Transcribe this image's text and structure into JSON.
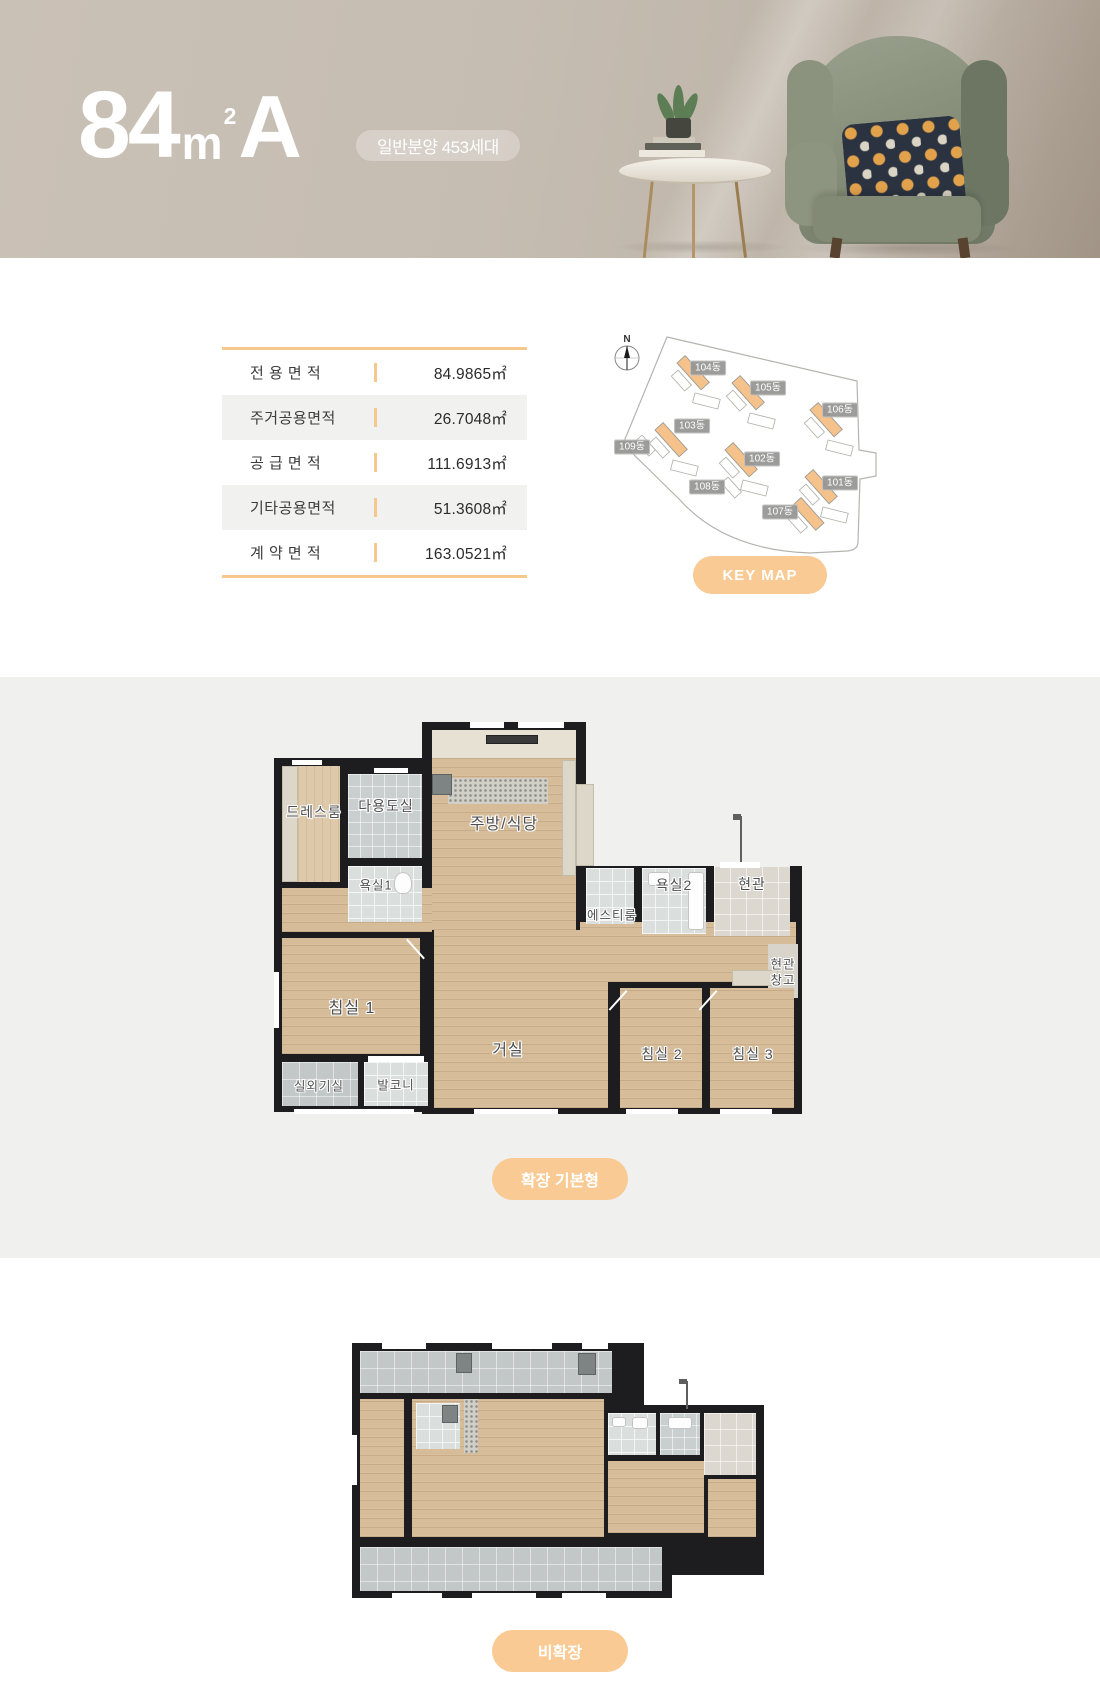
{
  "header": {
    "title_number": "84",
    "title_unit": "m",
    "title_unit_exponent": "2",
    "title_type": "A",
    "badge_label": "일반분양 453세대"
  },
  "area_table": {
    "rows": [
      {
        "label": "전 용 면 적",
        "value": "84.9865㎡"
      },
      {
        "label": "주거공용면적",
        "value": "26.7048㎡"
      },
      {
        "label": "공 급 면 적",
        "value": "111.6913㎡"
      },
      {
        "label": "기타공용면적",
        "value": "51.3608㎡"
      },
      {
        "label": "계 약 면 적",
        "value": "163.0521㎡"
      }
    ]
  },
  "keymap": {
    "compass_label": "N",
    "building_labels": [
      "104동",
      "105동",
      "106동",
      "103동",
      "109동",
      "102동",
      "108동",
      "101동",
      "107동"
    ],
    "button_label": "KEY MAP"
  },
  "floorplan_expanded": {
    "button_label": "확장 기본형",
    "room_labels": {
      "dressroom": "드레스룸",
      "utility": "다용도실",
      "bath1": "욕실1",
      "kitchen_dining": "주방/식당",
      "st_room": "에스티룸",
      "bath2": "욕실2",
      "entrance": "현관",
      "entrance_storage_line1": "현관",
      "entrance_storage_line2": "창고",
      "bedroom1": "침실 1",
      "living": "거실",
      "bedroom2": "침실 2",
      "bedroom3": "침실 3",
      "outdoor_unit": "실외기실",
      "balcony": "발코니"
    }
  },
  "floorplan_basic": {
    "button_label": "비확장"
  },
  "appearance": {
    "accent_orange": "#f8c992",
    "header_background": "#c7beb3",
    "section_gray_background": "#f0f0ee",
    "wall_color": "#1d1d1f",
    "wood_floor": "#d6bc99",
    "tile_gray": "#c9cecf",
    "chip_gray": "#949491"
  }
}
